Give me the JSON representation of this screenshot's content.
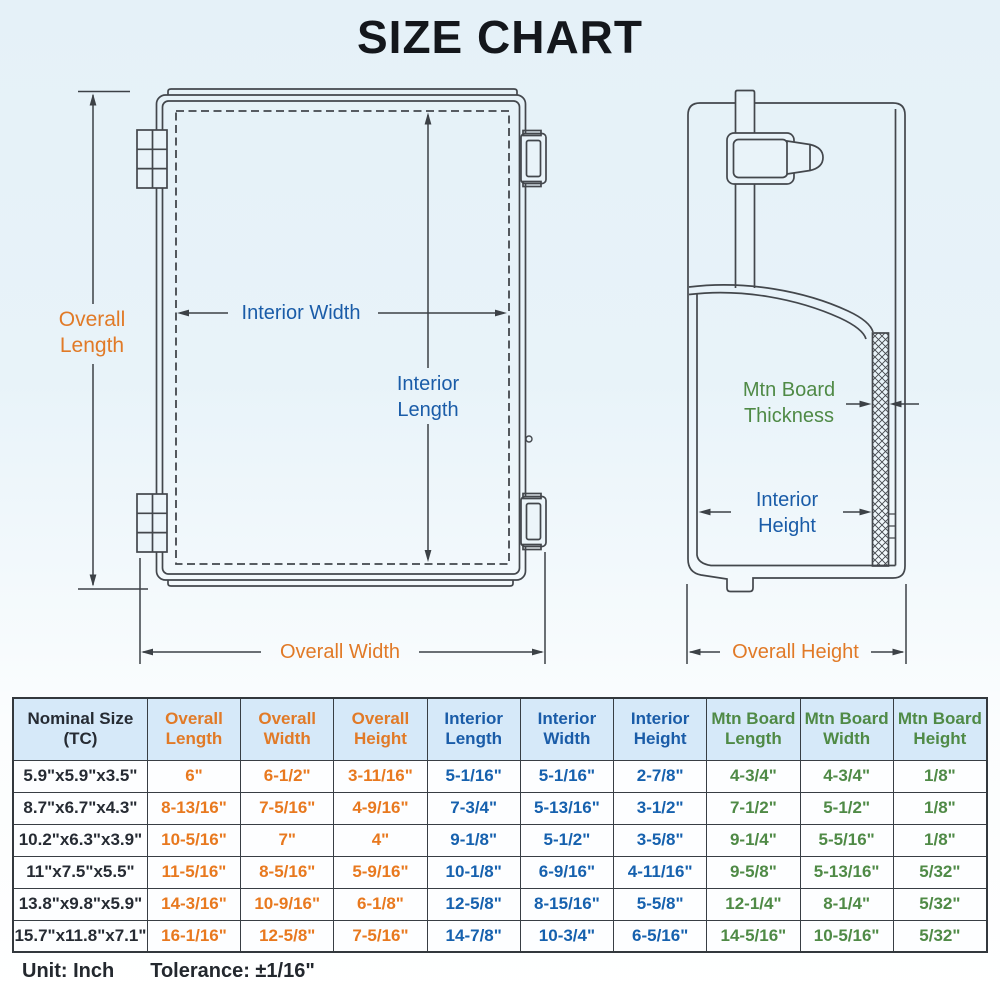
{
  "title": "SIZE CHART",
  "diagram": {
    "front": {
      "overall_length": "Overall\nLength",
      "interior_width": "Interior Width",
      "interior_length": "Interior\nLength",
      "overall_width": "Overall Width"
    },
    "side": {
      "mtn_board_thickness": "Mtn Board\nThickness",
      "interior_height": "Interior\nHeight",
      "overall_height": "Overall Height"
    }
  },
  "table": {
    "headers": [
      "Nominal Size\n(TC)",
      "Overall\nLength",
      "Overall\nWidth",
      "Overall\nHeight",
      "Interior\nLength",
      "Interior\nWidth",
      "Interior\nHeight",
      "Mtn Board\nLength",
      "Mtn Board\nWidth",
      "Mtn Board\nHeight"
    ],
    "rows": [
      [
        "5.9\"x5.9\"x3.5\"",
        "6\"",
        "6-1/2\"",
        "3-11/16\"",
        "5-1/16\"",
        "5-1/16\"",
        "2-7/8\"",
        "4-3/4\"",
        "4-3/4\"",
        "1/8\""
      ],
      [
        "8.7\"x6.7\"x4.3\"",
        "8-13/16\"",
        "7-5/16\"",
        "4-9/16\"",
        "7-3/4\"",
        "5-13/16\"",
        "3-1/2\"",
        "7-1/2\"",
        "5-1/2\"",
        "1/8\""
      ],
      [
        "10.2\"x6.3\"x3.9\"",
        "10-5/16\"",
        "7\"",
        "4\"",
        "9-1/8\"",
        "5-1/2\"",
        "3-5/8\"",
        "9-1/4\"",
        "5-5/16\"",
        "1/8\""
      ],
      [
        "11\"x7.5\"x5.5\"",
        "11-5/16\"",
        "8-5/16\"",
        "5-9/16\"",
        "10-1/8\"",
        "6-9/16\"",
        "4-11/16\"",
        "9-5/8\"",
        "5-13/16\"",
        "5/32\""
      ],
      [
        "13.8\"x9.8\"x5.9\"",
        "14-3/16\"",
        "10-9/16\"",
        "6-1/8\"",
        "12-5/8\"",
        "8-15/16\"",
        "5-5/8\"",
        "12-1/4\"",
        "8-1/4\"",
        "5/32\""
      ],
      [
        "15.7\"x11.8\"x7.1\"",
        "16-1/16\"",
        "12-5/8\"",
        "7-5/16\"",
        "14-7/8\"",
        "10-3/4\"",
        "6-5/16\"",
        "14-5/16\"",
        "10-5/16\"",
        "5/32\""
      ]
    ]
  },
  "footer": {
    "unit": "Unit: Inch",
    "tolerance": "Tolerance: ±1/16\""
  },
  "colors": {
    "accent_orange": "#E17A27",
    "accent_blue": "#1A5CA8",
    "accent_green": "#4F8A46",
    "line": "#43474C",
    "header_bg": "#D6E9F9",
    "background_top": "#E5F1F8",
    "background_bottom": "#FFFFFF",
    "title_text": "#14171C"
  }
}
